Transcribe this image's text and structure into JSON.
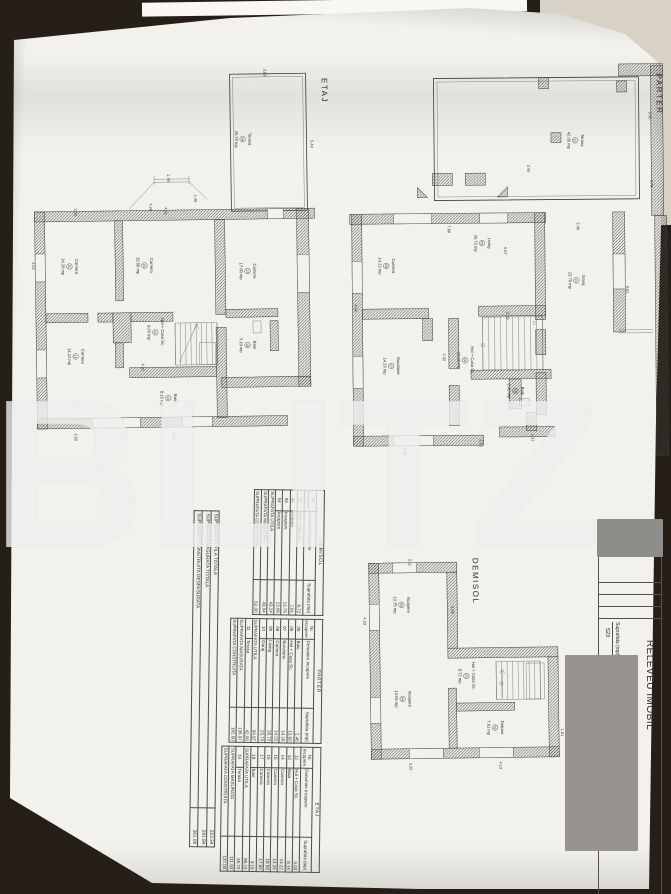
{
  "watermark": "BLITZ",
  "title_block": {
    "title": "RELEVEU IMOBIL",
    "scale": "Sc. 1:100",
    "surface_label": "Suprafata (mp)",
    "surface_value": "523"
  },
  "plans": {
    "etaj": {
      "label": "ETAJ",
      "rooms": [
        {
          "n": "19",
          "name": "Terasa",
          "area": "26.70 mp"
        },
        {
          "n": "15",
          "name": "Camera",
          "area": "14.26 mp"
        },
        {
          "n": "16",
          "name": "Camera",
          "area": "18.58 mp"
        },
        {
          "n": "17",
          "name": "Camera",
          "area": "17.80 mp"
        },
        {
          "n": "14",
          "name": "Camera",
          "area": "14.22 mp"
        },
        {
          "n": "12",
          "name": "Hol + Casa Sc.",
          "area": "9.03 mp"
        },
        {
          "n": "13",
          "name": "Baia",
          "area": "8.15 mp"
        },
        {
          "n": "18",
          "name": "Baie",
          "area": "3.19 mp"
        }
      ],
      "dims": [
        "3.83",
        "5.40",
        "1.79",
        "1.46",
        "4.26",
        "3.30",
        "4.31",
        "4.52",
        "4.31",
        "3.50",
        "4.31"
      ]
    },
    "parter": {
      "label": "PARTER",
      "rooms": [
        {
          "n": "11",
          "name": "Terasa",
          "area": "42.00 mp"
        },
        {
          "n": "08",
          "name": "Camera",
          "area": "14.22 mp"
        },
        {
          "n": "09",
          "name": "Living",
          "area": "26.73 mp"
        },
        {
          "n": "10",
          "name": "Garaj",
          "area": "23.70 mp"
        },
        {
          "n": "07",
          "name": "Bucatarie",
          "area": "14.26 mp"
        },
        {
          "n": "06",
          "name": "Hol + Casa Sc.",
          "area": "13.60 mp"
        },
        {
          "n": "05",
          "name": "Baie",
          "area": "2.46 mp"
        }
      ],
      "dims": [
        "2.30",
        "2.40",
        "2.78",
        "7.88",
        "2.48",
        "5.67",
        "2.33",
        "5.61",
        "4.92",
        "4.32",
        "3.30",
        "2.50",
        "1.31"
      ]
    },
    "demisol": {
      "label": "DEMISOL",
      "rooms": [
        {
          "n": "03",
          "name": "Incapere",
          "area": "13.75 mp"
        },
        {
          "n": "04",
          "name": "Incapere",
          "area": "13.06 mp"
        },
        {
          "n": "01",
          "name": "Hol + Casa Sc.",
          "area": "8.72 mp"
        },
        {
          "n": "02",
          "name": "Debara",
          "area": "7.61 mp"
        }
      ],
      "dims": [
        "3.11",
        "4.23",
        "5.05",
        "3.25",
        "4.13",
        "1.81"
      ]
    }
  },
  "tables": {
    "floors": [
      {
        "title": "DEMISOL",
        "headers": [
          "Nr. Incapere",
          "Denumire Incapere",
          "Suprafata (mp)"
        ],
        "rows": [
          [
            "01",
            "Hol + Casa Sc.",
            "8.72"
          ],
          [
            "02",
            "Debara",
            "7.61"
          ],
          [
            "03",
            "Incapere",
            "13.75"
          ],
          [
            "04",
            "Incapere",
            "13.06"
          ],
          [
            "SUPRAFATA UTILA",
            "43.14"
          ],
          [
            "SUPRAFATA MASURATA",
            "43.04"
          ],
          [
            "SUPRAFATA CONSTRUITA",
            "62.00"
          ]
        ]
      },
      {
        "title": "PARTER",
        "headers": [
          "Nr. Incapere",
          "Denumire Incapere",
          "Suprafata (mp)"
        ],
        "rows": [
          [
            "05",
            "Baie",
            "2.46"
          ],
          [
            "06",
            "Hol + Casa Sc.",
            "13.60"
          ],
          [
            "07",
            "Bucatarie",
            "14.26"
          ],
          [
            "08",
            "Camera",
            "14.22"
          ],
          [
            "09",
            "Living",
            "26.73"
          ],
          [
            "10",
            "Garaj",
            "23.70"
          ],
          [
            "SUPRAFATA UTILA",
            "94.97"
          ],
          [
            "11",
            "Terasa",
            "42.00"
          ],
          [
            "SUPRAFATA MASURATA",
            "136.97"
          ],
          [
            "SUPRAFATA CONSTRUITA",
            "162.00"
          ]
        ]
      },
      {
        "title": "ETAJ",
        "headers": [
          "Nr. Incapere",
          "Denumire Incapere",
          "Suprafata (mp)"
        ],
        "rows": [
          [
            "12",
            "Hol + Casa Sc.",
            "9.03"
          ],
          [
            "13",
            "Baia",
            "8.15"
          ],
          [
            "14",
            "Camera",
            "14.22"
          ],
          [
            "15",
            "Camera",
            "14.26"
          ],
          [
            "16",
            "Camera",
            "18.58"
          ],
          [
            "17",
            "Camera",
            "17.80"
          ],
          [
            "18",
            "Baie",
            "3.19"
          ],
          [
            "SUPRAFATA UTILA",
            "85.23"
          ],
          [
            "19",
            "Terasa",
            "26.70"
          ],
          [
            "SUPRAFATA MASURATA",
            "111.93"
          ],
          [
            "SUPRAFATA CONSTRUITA",
            "137.00"
          ]
        ]
      }
    ],
    "summary": [
      [
        "SUPRAFATA UTILA TOTALA",
        "223.34"
      ],
      [
        "SUPRAFATA MASURATA TOTALA",
        "291.94"
      ],
      [
        "SUPRAFATA CONSTRUITA DESFASURATA",
        "361.00"
      ]
    ]
  }
}
